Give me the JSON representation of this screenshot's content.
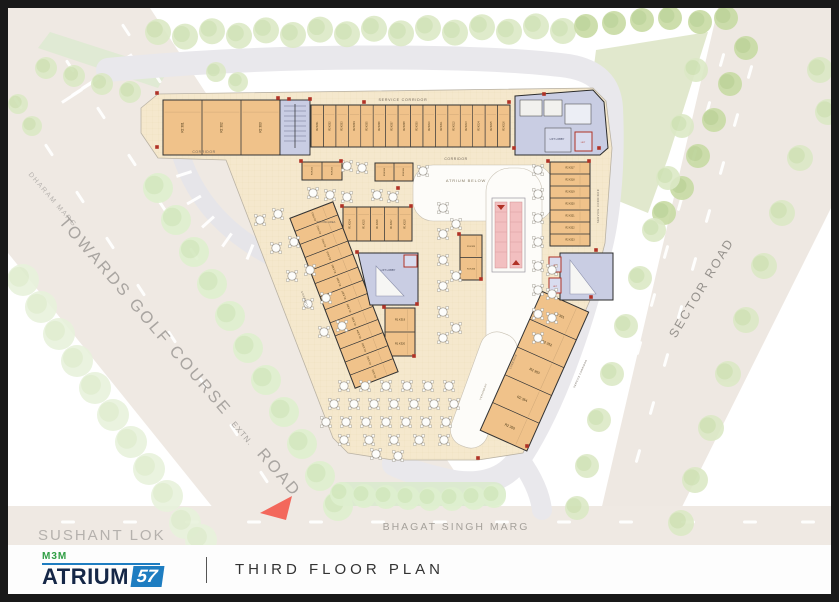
{
  "footer": {
    "brand_top": "M3M",
    "brand_name": "ATRIUM",
    "brand_number": "57",
    "title": "THIRD FLOOR PLAN"
  },
  "roads": {
    "dharam_marg": "DHARAM MARG",
    "towards_golf": "TOWARDS GOLF COURSE",
    "extn": "EXTN.",
    "road_word": "ROAD",
    "sector_road": "SECTOR ROAD",
    "bhagat_singh_marg": "BHAGAT SINGH MARG",
    "locality": "SUSHANT LOK"
  },
  "plan": {
    "labels": {
      "service_corridor": "SERVICE CORRIDOR",
      "corridor": "CORRIDOR",
      "atrium_below": "ATRIUM BELOW",
      "verandah": "VERANDAH",
      "waiting_area": "WAITING AREA",
      "lift_lobby": "LIFT LOBBY",
      "lift": "LIFT"
    },
    "top_left_units": [
      "R2 301",
      "R2 302",
      "R2 303"
    ],
    "top_row_units": [
      "R2 K301",
      "R2 K302",
      "R2 K303",
      "R2 K304",
      "R2 K305",
      "R2 K306",
      "R2 K307",
      "R2 K308",
      "R2 K309",
      "R2 K310",
      "R2 K311",
      "R2 K312",
      "R2 K313",
      "R2 K314",
      "R2 K315",
      "R2 K316"
    ],
    "right_strip_units": [
      "R2 K317",
      "R2 K318",
      "R2 K319",
      "R2 K320",
      "R2 K321",
      "R2 K322",
      "R2 K323"
    ],
    "mini_row_units": [
      "R1 K314",
      "R1 K315",
      "R1 K316",
      "R1 K317",
      "R1 K318"
    ],
    "central_strip_units": [
      "R1 K313",
      "R1 K312",
      "R1 K311",
      "R1 K310",
      "R1 K309",
      "R1 K308",
      "R1 K307",
      "R1 K306",
      "R1 K305",
      "R1 K304",
      "R1 K303",
      "R1 K302",
      "R1 K301"
    ],
    "side_units": [
      "R1 K319",
      "R1 K320"
    ],
    "kiosk_units": [
      "R1 K321",
      "R1 K322",
      "R1 K323",
      "R1 K324",
      "R1 K325",
      "R1 K326"
    ],
    "bottom_right_units": [
      "R2 351",
      "R2 352",
      "R2 353",
      "R2 354",
      "R2 355"
    ]
  },
  "colors": {
    "unit": "#f0c28a",
    "unit_line": "#2b2b2b",
    "core": "#c9cde3",
    "escalator": "#f2bfc0",
    "floor": "#f5e8cd",
    "road": "#efe9e3",
    "lawn": "#e1e8cd",
    "arrow": "#f3685c",
    "marker_red": "#b03226"
  }
}
